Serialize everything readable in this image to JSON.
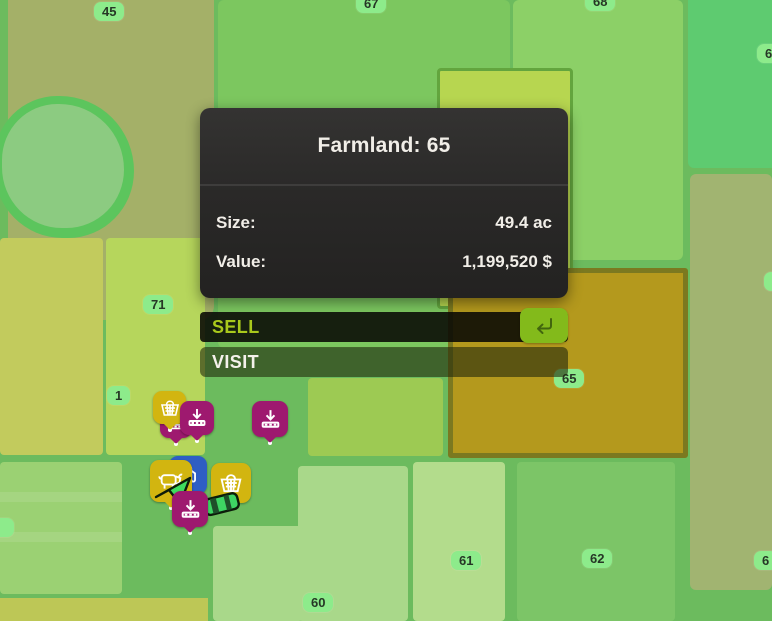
{
  "tooltip": {
    "title": "Farmland: 65",
    "rows": [
      {
        "label": "Size:",
        "value": "49.4 ac"
      },
      {
        "label": "Value:",
        "value": "1,199,520 $"
      }
    ]
  },
  "actions": {
    "sell_label": "SELL",
    "visit_label": "VISIT",
    "sell_shortcut_icon": "return-key-icon"
  },
  "badges": {
    "b45": "45",
    "b67": "67",
    "b68": "68",
    "b6_top_right": "6",
    "b71": "71",
    "b1": "1",
    "b65": "65",
    "b6_mid_right": "",
    "b60": "60",
    "b61": "61",
    "b62": "62",
    "b6_bottom_right": "6",
    "b_left_edge": ""
  },
  "map_icons": [
    "shopping-basket-icon",
    "unloading-point-icon",
    "unloading-point-icon",
    "animal-dealer-icon",
    "fuel-station-icon",
    "player-marker-icon",
    "unloading-point-icon",
    "shopping-basket-icon",
    "vehicle-marker"
  ],
  "colors": {
    "selected_farmland": "#b4991d",
    "selected_farmland_border": "#7b7920",
    "owned_parcel_highlight": "#b7d650",
    "badge_bg": "#8deb8b",
    "sell_text": "#a9c91c",
    "return_button": "#83ba1b",
    "pin_yellow": "#d2b510",
    "pin_purple": "#9e196f",
    "pin_blue": "#2e5ec4",
    "player_marker_green": "#3fdc5f",
    "panel_bg": "#2a2928"
  }
}
